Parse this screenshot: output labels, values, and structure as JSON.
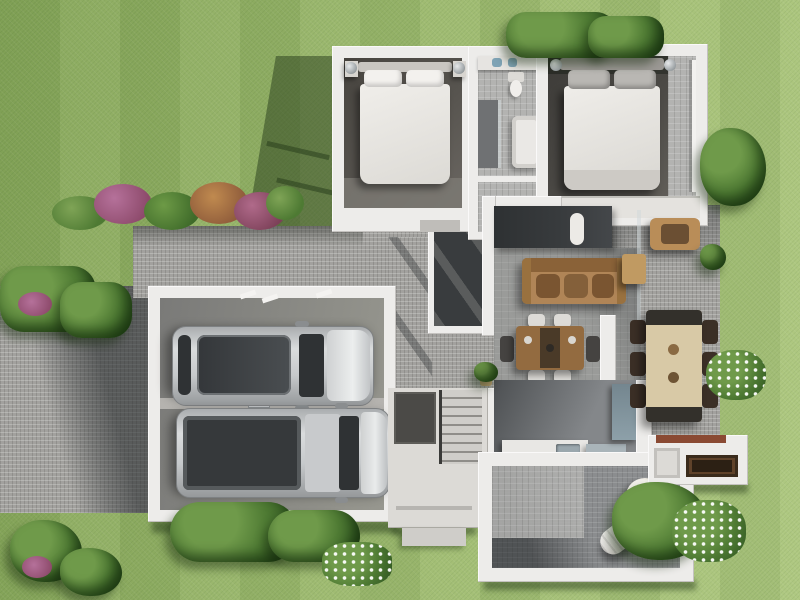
{
  "scene": {
    "type": "3d-floor-plan-render",
    "view": "top-down",
    "rooms": [
      "bedroom-1",
      "bathroom",
      "bedroom-2",
      "hallway",
      "courtyard",
      "living-room",
      "dining-area",
      "kitchen",
      "staircase",
      "entry",
      "garage",
      "alfresco-room",
      "outdoor-dining-patio",
      "braai-area"
    ],
    "outdoor_features": [
      "lawn",
      "driveway",
      "front-court",
      "flower-bed",
      "hedge",
      "bushes",
      "potted-plants"
    ]
  },
  "labels": {
    "scene": "Top-down 3D render of a house floor plan with garden",
    "lawn": "Lawn",
    "driveway": "Paved driveway",
    "front_court": "Paved front court",
    "flower_bed": "Flower bed",
    "garage": "Double garage",
    "car1": "Silver SUV",
    "car2": "Silver pickup truck",
    "bedroom1": "Bedroom 1",
    "bed1": "Double bed",
    "bathroom": "Bathroom",
    "bedroom2": "Main bedroom",
    "bed2": "Double bed",
    "courtyard": "Internal courtyard",
    "living": "Living room",
    "tv_wall": "TV media wall",
    "sofa": "Sofa",
    "dining": "Dining table with chairs",
    "kitchen": "Kitchen",
    "stairs": "Staircase",
    "entry": "Entry porch",
    "alfresco": "Alfresco room",
    "lounger": "Rolled lounger cushion",
    "round_chair": "Round rattan chair",
    "outdoor_table": "Outdoor dining table",
    "braai": "Built-in braai",
    "hedge": "Hedge",
    "bushes": "Garden bushes"
  },
  "palette": {
    "grass_base": "#9cb96d",
    "grass_light": "#adc77e",
    "grass_dark": "#86a659",
    "paver": "#a2a19e",
    "paver_dark": "#5c6062",
    "wall": "#edecea",
    "floor_tile": "#b3b3b1",
    "floor_room_dark": "#57544f",
    "floor_room2": "#4b4945",
    "floor_living": "#9a9b99",
    "floor_kitchen": "#84878a",
    "floor_alfresco": "#8b8d8f",
    "charcoal": "#393c3e",
    "sofa_tan": "#b08557",
    "wood": "#936b40",
    "outdoor_beige": "#d8c9a6",
    "car_silver": "#c6c9cb",
    "glass_dark": "#2f3234",
    "braai_wood": "#5f422a",
    "roof_red": "#8a4a33",
    "bush_green": "#4e7a33",
    "bush_light": "#6f9a4a",
    "flower_pink": "#b06a8a"
  }
}
